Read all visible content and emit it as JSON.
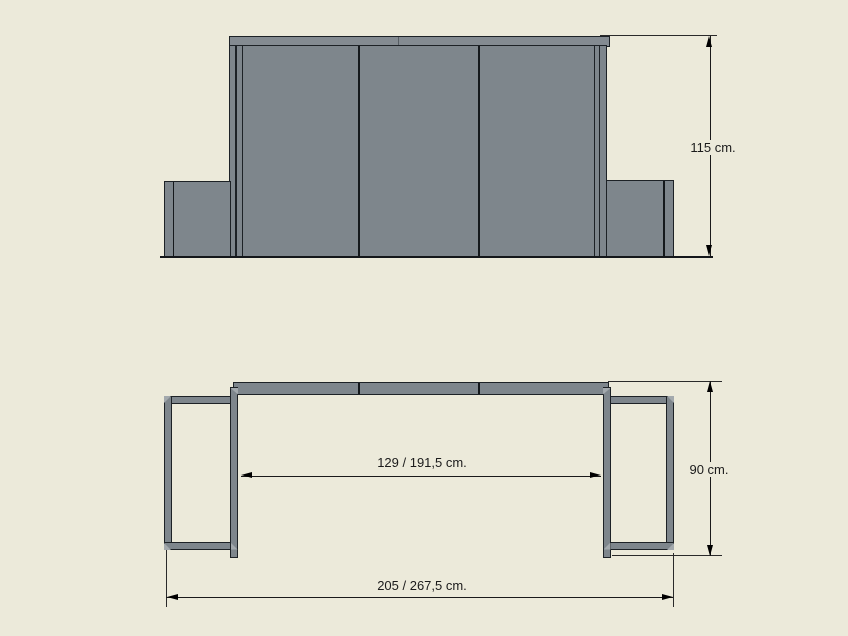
{
  "colors": {
    "background": "#ECEADA",
    "panel_gray": "#7E868C",
    "cap_gray": "#848B91",
    "bevel_light": "#A3A9AD",
    "outline": "#1d2226",
    "dimension": "#1a1a1a"
  },
  "front_view": {
    "height_dimension": "115 cm."
  },
  "plan_view": {
    "inner_width_dimension": "129 / 191,5 cm.",
    "depth_dimension": "90 cm.",
    "overall_width_dimension": "205 / 267,5 cm."
  }
}
